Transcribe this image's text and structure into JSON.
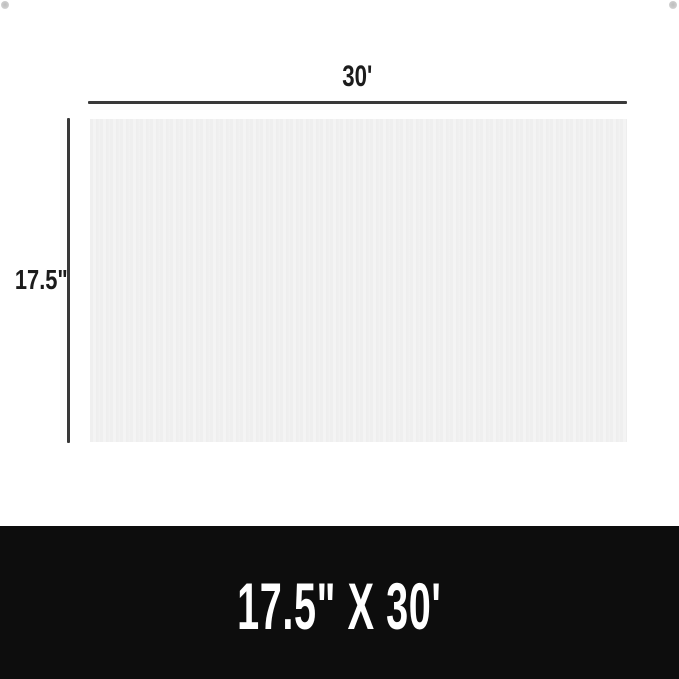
{
  "diagram": {
    "top_dimension": {
      "label": "30'"
    },
    "left_dimension": {
      "label": "17.5\""
    },
    "sheet": {
      "description": "white corrugated sheet"
    }
  },
  "banner": {
    "size_text": "17.5\" X 30'"
  },
  "colors": {
    "background": "#ffffff",
    "dimension_line": "#3a3a3a",
    "dimension_label": "#1c1c1c",
    "sheet_fill_light": "#f4f4f4",
    "sheet_fill_dark": "#ededed",
    "banner_background": "#0d0d0d",
    "banner_text": "#ffffff",
    "corner_dot": "#c6c6c6"
  }
}
